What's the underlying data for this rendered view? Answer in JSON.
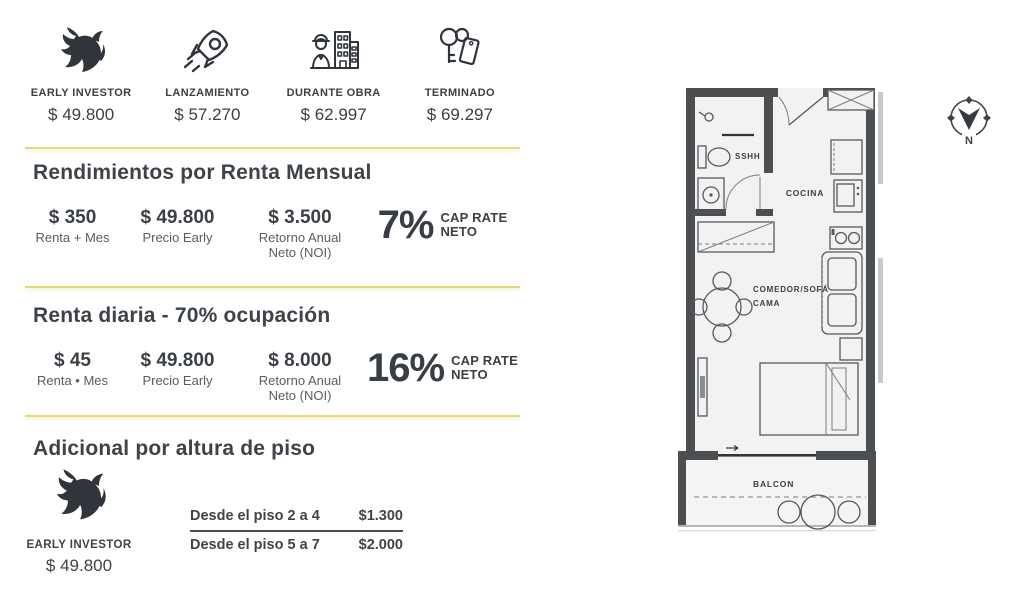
{
  "tiers": [
    {
      "icon": "bull-icon",
      "label": "EARLY INVESTOR",
      "price": "$ 49.800"
    },
    {
      "icon": "rocket-icon",
      "label": "LANZAMIENTO",
      "price": "$ 57.270"
    },
    {
      "icon": "construction-icon",
      "label": "DURANTE OBRA",
      "price": "$ 62.997"
    },
    {
      "icon": "keys-icon",
      "label": "TERMINADO",
      "price": "$ 69.297"
    }
  ],
  "monthly": {
    "title": "Rendimientos por Renta Mensual",
    "stat1": {
      "value": "$ 350",
      "line1": "Renta + Mes"
    },
    "stat2": {
      "value": "$ 49.800",
      "line1": "Precio Early"
    },
    "stat3": {
      "value": "$ 3.500",
      "line1": "Retorno Anual",
      "line2": "Neto (NOI)"
    },
    "cap": {
      "value": "7%",
      "line1": "CAP RATE",
      "line2": "NETO"
    }
  },
  "daily": {
    "title": "Renta diaria - 70% ocupación",
    "stat1": {
      "value": "$ 45",
      "line1": "Renta • Mes"
    },
    "stat2": {
      "value": "$ 49.800",
      "line1": "Precio Early"
    },
    "stat3": {
      "value": "$ 8.000",
      "line1": "Retorno Anual",
      "line2": "Neto (NOI)"
    },
    "cap": {
      "value": "16%",
      "line1": "CAP RATE",
      "line2": "NETO"
    }
  },
  "floor_height": {
    "title": "Adicional por altura de piso",
    "investor": {
      "icon": "bull-icon",
      "label": "EARLY INVESTOR",
      "price": "$ 49.800"
    },
    "table": [
      {
        "label": "Desde el piso 2 a 4",
        "value": "$1.300"
      },
      {
        "label": "Desde el piso 5 a 7",
        "value": "$2.000"
      }
    ]
  },
  "floor_plan": {
    "bathroom_label": "SSHH",
    "kitchen_label": "COCINA",
    "living_label_line1": "COMEDOR/SOFÁ",
    "living_label_line2": "CAMA",
    "balcony_label": "BALCON",
    "compass_north": "N"
  },
  "colors": {
    "accent_yellow": "#EAD47C",
    "text_dark": "#3D4348",
    "wall": "#4B4F52"
  }
}
